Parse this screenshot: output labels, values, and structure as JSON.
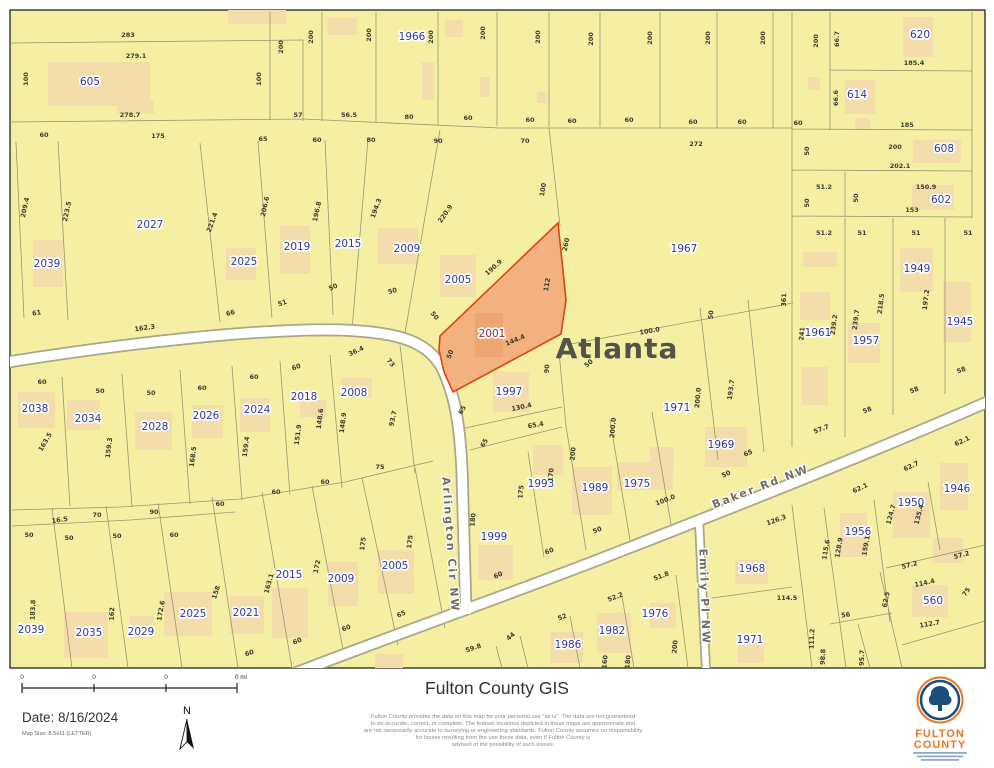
{
  "theme": {
    "map_bg": "#f4efa3",
    "bldg": "#f2ddab",
    "line": "#97966f",
    "casing": "#a8a786",
    "hl_fill": "#f2b17e",
    "hl_stroke": "#dd4414",
    "hl_bldg": "#eda571",
    "parcel": "#2e3799",
    "hl_label": "#8d2748",
    "dim": "#3b3b2d",
    "city": "#53534c",
    "street_label": "#6e6e64",
    "logo_orange": "#e87722",
    "logo_blue": "#1d4e79"
  },
  "map": {
    "label_format": "[text, x, y, rotation, class: p=parcel ph=highlighted-parcel d=dimension c=city s=street]",
    "city_name": "Atlanta",
    "highlighted_parcel": "2001",
    "street_names": [
      "Arlington Cir NW",
      "Baker Rd NW",
      "Emily Pl NW"
    ],
    "labels": [
      [
        "605",
        90,
        85,
        0,
        "p"
      ],
      [
        "1966",
        412,
        40,
        0,
        "p"
      ],
      [
        "620",
        920,
        38,
        0,
        "p"
      ],
      [
        "614",
        857,
        98,
        0,
        "p"
      ],
      [
        "608",
        944,
        152,
        0,
        "p"
      ],
      [
        "602",
        941,
        203,
        0,
        "p"
      ],
      [
        "2027",
        150,
        228,
        0,
        "p"
      ],
      [
        "2039",
        47,
        267,
        0,
        "p"
      ],
      [
        "2025",
        244,
        265,
        0,
        "p"
      ],
      [
        "2019",
        297,
        250,
        0,
        "p"
      ],
      [
        "2015",
        348,
        247,
        0,
        "p"
      ],
      [
        "2009",
        407,
        252,
        0,
        "p"
      ],
      [
        "2005",
        458,
        283,
        0,
        "p"
      ],
      [
        "2001",
        492,
        337,
        0,
        "ph"
      ],
      [
        "1967",
        684,
        252,
        0,
        "p"
      ],
      [
        "1961",
        818,
        336,
        0,
        "p"
      ],
      [
        "1957",
        866,
        344,
        0,
        "p"
      ],
      [
        "1949",
        917,
        272,
        0,
        "p"
      ],
      [
        "1945",
        960,
        325,
        0,
        "p"
      ],
      [
        "2038",
        35,
        412,
        0,
        "p"
      ],
      [
        "2034",
        88,
        422,
        0,
        "p"
      ],
      [
        "2028",
        155,
        430,
        0,
        "p"
      ],
      [
        "2026",
        206,
        419,
        0,
        "p"
      ],
      [
        "2024",
        257,
        413,
        0,
        "p"
      ],
      [
        "2018",
        304,
        400,
        0,
        "p"
      ],
      [
        "2008",
        354,
        396,
        0,
        "p"
      ],
      [
        "1997",
        509,
        395,
        0,
        "p"
      ],
      [
        "1993",
        541,
        487,
        0,
        "p"
      ],
      [
        "1989",
        595,
        491,
        0,
        "p"
      ],
      [
        "1975",
        637,
        487,
        0,
        "p"
      ],
      [
        "1971",
        677,
        411,
        0,
        "p"
      ],
      [
        "1969",
        721,
        448,
        0,
        "p"
      ],
      [
        "1999",
        494,
        540,
        0,
        "p"
      ],
      [
        "2005",
        395,
        569,
        0,
        "p"
      ],
      [
        "2009",
        341,
        582,
        0,
        "p"
      ],
      [
        "2015",
        289,
        578,
        0,
        "p"
      ],
      [
        "2021",
        246,
        616,
        0,
        "p"
      ],
      [
        "2025",
        193,
        617,
        0,
        "p"
      ],
      [
        "2029",
        141,
        635,
        0,
        "p"
      ],
      [
        "2035",
        89,
        636,
        0,
        "p"
      ],
      [
        "2039",
        31,
        633,
        0,
        "p"
      ],
      [
        "1986",
        568,
        648,
        0,
        "p"
      ],
      [
        "1982",
        612,
        634,
        0,
        "p"
      ],
      [
        "1976",
        655,
        617,
        0,
        "p"
      ],
      [
        "1968",
        752,
        572,
        0,
        "p"
      ],
      [
        "1971",
        750,
        643,
        0,
        "p"
      ],
      [
        "1956",
        858,
        535,
        0,
        "p"
      ],
      [
        "1950",
        911,
        506,
        0,
        "p"
      ],
      [
        "1946",
        957,
        492,
        0,
        "p"
      ],
      [
        "560",
        933,
        604,
        0,
        "p"
      ],
      [
        "Atlanta",
        617,
        358,
        0,
        "c"
      ],
      [
        "Arlington Cir NW",
        447,
        545,
        86,
        "s"
      ],
      [
        "Baker Rd NW",
        762,
        490,
        -21,
        "s"
      ],
      [
        "Emily Pl NW",
        701,
        597,
        88,
        "s"
      ],
      [
        "283",
        128,
        37,
        0
      ],
      [
        "279.1",
        136,
        58,
        0
      ],
      [
        "100",
        28,
        79,
        -90
      ],
      [
        "100",
        261,
        79,
        -90
      ],
      [
        "200",
        283,
        47,
        -90
      ],
      [
        "200",
        313,
        37,
        -90
      ],
      [
        "200",
        371,
        35,
        -90
      ],
      [
        "200",
        433,
        37,
        -90
      ],
      [
        "200",
        485,
        33,
        -90
      ],
      [
        "200",
        540,
        37,
        -90
      ],
      [
        "200",
        593,
        39,
        -90
      ],
      [
        "200",
        652,
        38,
        -90
      ],
      [
        "200",
        710,
        38,
        -90
      ],
      [
        "200",
        765,
        38,
        -90
      ],
      [
        "200",
        818,
        41,
        -90
      ],
      [
        "278.7",
        130,
        117,
        0
      ],
      [
        "57",
        298,
        117,
        0
      ],
      [
        "56.5",
        349,
        117,
        0
      ],
      [
        "80",
        409,
        119,
        0
      ],
      [
        "60",
        468,
        120,
        0
      ],
      [
        "60",
        530,
        122,
        0
      ],
      [
        "60",
        572,
        123,
        0
      ],
      [
        "60",
        629,
        122,
        0
      ],
      [
        "60",
        693,
        124,
        0
      ],
      [
        "60",
        742,
        124,
        0
      ],
      [
        "60",
        798,
        125,
        0
      ],
      [
        "60",
        44,
        137,
        0
      ],
      [
        "175",
        158,
        138,
        0
      ],
      [
        "65",
        263,
        141,
        0
      ],
      [
        "60",
        317,
        142,
        0
      ],
      [
        "80",
        371,
        142,
        0
      ],
      [
        "90",
        438,
        143,
        0
      ],
      [
        "70",
        525,
        143,
        0
      ],
      [
        "66.7",
        839,
        39,
        -90
      ],
      [
        "185.4",
        914,
        65,
        0
      ],
      [
        "66.6",
        838,
        98,
        -90
      ],
      [
        "185",
        907,
        127,
        0
      ],
      [
        "50",
        809,
        151,
        -90
      ],
      [
        "200",
        895,
        149,
        0
      ],
      [
        "202.1",
        900,
        168,
        0
      ],
      [
        "51.2",
        824,
        189,
        0
      ],
      [
        "50",
        858,
        198,
        -90
      ],
      [
        "50",
        809,
        203,
        -90
      ],
      [
        "150.9",
        926,
        189,
        0
      ],
      [
        "153",
        912,
        212,
        0
      ],
      [
        "272",
        696,
        146,
        0
      ],
      [
        "100",
        545,
        190,
        -80
      ],
      [
        "260",
        568,
        245,
        -78
      ],
      [
        "361",
        786,
        300,
        -88
      ],
      [
        "51.2",
        824,
        235,
        0
      ],
      [
        "51",
        862,
        235,
        0
      ],
      [
        "51",
        916,
        235,
        0
      ],
      [
        "51",
        968,
        235,
        0
      ],
      [
        "241",
        804,
        334,
        -85
      ],
      [
        "239.2",
        836,
        325,
        -83
      ],
      [
        "239.7",
        858,
        320,
        -83
      ],
      [
        "218.5",
        883,
        304,
        -83
      ],
      [
        "197.2",
        928,
        300,
        -83
      ],
      [
        "58",
        962,
        372,
        -21
      ],
      [
        "58",
        915,
        392,
        -21
      ],
      [
        "58",
        868,
        412,
        -21
      ],
      [
        "57.7",
        822,
        431,
        -21
      ],
      [
        "209.4",
        27,
        208,
        -78
      ],
      [
        "223.5",
        69,
        212,
        -78
      ],
      [
        "221.4",
        214,
        223,
        -70
      ],
      [
        "206.6",
        267,
        207,
        -78
      ],
      [
        "196.8",
        319,
        212,
        -78
      ],
      [
        "194.3",
        378,
        209,
        -70
      ],
      [
        "220.9",
        447,
        215,
        -55
      ],
      [
        "190.9",
        495,
        269,
        -42
      ],
      [
        "112",
        549,
        285,
        -80
      ],
      [
        "144.4",
        516,
        342,
        -23
      ],
      [
        "50",
        452,
        355,
        -70
      ],
      [
        "61",
        37,
        315,
        -10
      ],
      [
        "162.3",
        145,
        330,
        -8
      ],
      [
        "66",
        231,
        315,
        -15
      ],
      [
        "51",
        283,
        305,
        -20
      ],
      [
        "50",
        334,
        289,
        -25
      ],
      [
        "50",
        393,
        293,
        -15
      ],
      [
        "50",
        433,
        317,
        50
      ],
      [
        "36.4",
        357,
        353,
        -25
      ],
      [
        "73",
        389,
        364,
        50
      ],
      [
        "100.0",
        650,
        333,
        -10
      ],
      [
        "50",
        590,
        365,
        -40
      ],
      [
        "90",
        549,
        369,
        -85
      ],
      [
        "50",
        713,
        315,
        -85
      ],
      [
        "200.0",
        615,
        428,
        -85
      ],
      [
        "200.0",
        700,
        398,
        -85
      ],
      [
        "193.7",
        733,
        390,
        -82
      ],
      [
        "65",
        749,
        455,
        -25
      ],
      [
        "50",
        727,
        476,
        -25
      ],
      [
        "100.0",
        666,
        502,
        -21
      ],
      [
        "130.4",
        522,
        409,
        -12
      ],
      [
        "65.4",
        536,
        427,
        -10
      ],
      [
        "65",
        464,
        411,
        -60
      ],
      [
        "65",
        486,
        444,
        -60
      ],
      [
        "175",
        523,
        492,
        -85
      ],
      [
        "170",
        553,
        475,
        -85
      ],
      [
        "200",
        575,
        454,
        -85
      ],
      [
        "50",
        598,
        532,
        -21
      ],
      [
        "60",
        550,
        553,
        -21
      ],
      [
        "180",
        475,
        520,
        -85
      ],
      [
        "60",
        499,
        577,
        -25
      ],
      [
        "60",
        42,
        384,
        0
      ],
      [
        "50",
        100,
        393,
        0
      ],
      [
        "50",
        151,
        395,
        0
      ],
      [
        "60",
        202,
        390,
        0
      ],
      [
        "60",
        254,
        379,
        0
      ],
      [
        "60",
        297,
        369,
        -20
      ],
      [
        "163.5",
        47,
        443,
        -60
      ],
      [
        "159.3",
        111,
        448,
        -83
      ],
      [
        "168.5",
        195,
        457,
        -83
      ],
      [
        "159.4",
        248,
        447,
        -83
      ],
      [
        "151.9",
        300,
        435,
        -83
      ],
      [
        "148.6",
        322,
        419,
        -83
      ],
      [
        "148.9",
        345,
        423,
        -83
      ],
      [
        "93.7",
        395,
        419,
        -77
      ],
      [
        "75",
        380,
        469,
        0
      ],
      [
        "60",
        325,
        484,
        0
      ],
      [
        "60",
        276,
        494,
        0
      ],
      [
        "60",
        220,
        506,
        0
      ],
      [
        "90",
        154,
        514,
        0
      ],
      [
        "70",
        97,
        517,
        0
      ],
      [
        "16.5",
        60,
        522,
        -8
      ],
      [
        "50",
        29,
        537,
        0
      ],
      [
        "50",
        69,
        540,
        0
      ],
      [
        "50",
        117,
        538,
        0
      ],
      [
        "60",
        174,
        537,
        0
      ],
      [
        "158",
        218,
        593,
        -72
      ],
      [
        "163.1",
        271,
        584,
        -75
      ],
      [
        "172",
        319,
        567,
        -78
      ],
      [
        "175",
        365,
        544,
        -83
      ],
      [
        "175",
        412,
        542,
        -83
      ],
      [
        "183.8",
        35,
        610,
        -88
      ],
      [
        "162",
        114,
        614,
        -88
      ],
      [
        "172.6",
        163,
        611,
        -80
      ],
      [
        "60",
        250,
        655,
        -18
      ],
      [
        "60",
        298,
        643,
        -21
      ],
      [
        "60",
        347,
        630,
        -21
      ],
      [
        "65",
        402,
        616,
        -23
      ],
      [
        "59.8",
        474,
        650,
        -18
      ],
      [
        "44",
        512,
        638,
        -40
      ],
      [
        "52",
        563,
        619,
        -21
      ],
      [
        "52.2",
        616,
        599,
        -21
      ],
      [
        "51.8",
        662,
        578,
        -21
      ],
      [
        "200",
        677,
        647,
        -85
      ],
      [
        "180",
        630,
        662,
        -85
      ],
      [
        "160",
        607,
        662,
        -85
      ],
      [
        "126.3",
        777,
        522,
        -20
      ],
      [
        "114.5",
        787,
        600,
        0
      ],
      [
        "115.6",
        828,
        550,
        -80
      ],
      [
        "128.9",
        841,
        548,
        -80
      ],
      [
        "159.1",
        868,
        546,
        -80
      ],
      [
        "57.2",
        910,
        567,
        -14
      ],
      [
        "57.2",
        962,
        557,
        -14
      ],
      [
        "114.4",
        925,
        585,
        -12
      ],
      [
        "112.7",
        930,
        626,
        -10
      ],
      [
        "62.5",
        888,
        600,
        -78
      ],
      [
        "75",
        968,
        593,
        -55
      ],
      [
        "56",
        846,
        617,
        -8
      ],
      [
        "111.2",
        814,
        639,
        -87
      ],
      [
        "98.8",
        825,
        657,
        -87
      ],
      [
        "95.7",
        864,
        658,
        -87
      ],
      [
        "62.1",
        963,
        443,
        -25
      ],
      [
        "62.7",
        912,
        468,
        -25
      ],
      [
        "62.1",
        861,
        490,
        -25
      ],
      [
        "124.7",
        893,
        515,
        -75
      ],
      [
        "135.4",
        921,
        515,
        -75
      ]
    ]
  },
  "footer": {
    "title": "Fulton County GIS",
    "disclaimer": [
      "Fulton County provides the data on this map for your personal use \"as is\". The data are not guaranteed",
      "to be accurate, correct, or complete. The feature locations depicted in these maps are approximate and",
      "are not necessarily accurate to surveying or engineering standards. Fulton County assumes no responsibility",
      "for losses resulting from the use these data, even if Fulton County is",
      "advised of the possibility of such losses."
    ],
    "date": "Date: 8/16/2024",
    "map_size": "Map Size: 8.5x11 (LETTER)",
    "scale_labels": [
      "0",
      "0",
      "0",
      "0 mi"
    ],
    "north_label": "N",
    "logo": {
      "line1": "FULTON",
      "line2": "COUNTY"
    }
  }
}
